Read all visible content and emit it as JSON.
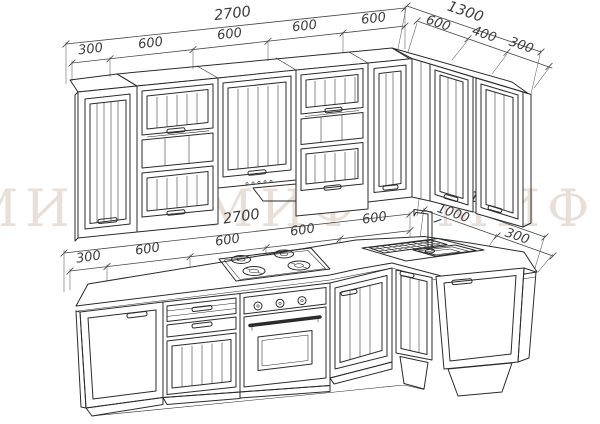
{
  "drawing": {
    "type": "kitchen-corner-set-technical-drawing",
    "background": "#ffffff",
    "line_color": "#2b2b2b",
    "dimension_text_color": "#3d3d3d"
  },
  "watermark": {
    "text": "МИФ  МИФ  МИФ  МИФ",
    "color": "#d3c0b5"
  },
  "dimensions": {
    "upper_left": {
      "overall": "2700",
      "segments": [
        "300",
        "600",
        "600",
        "600",
        "600"
      ]
    },
    "upper_right": {
      "overall": "1300",
      "segments": [
        "600",
        "400",
        "300"
      ]
    },
    "base_left": {
      "overall": "2700",
      "segments": [
        "300",
        "600",
        "600",
        "600",
        "600"
      ]
    },
    "base_right": {
      "overall": "1300",
      "segments": [
        "1000",
        "300"
      ]
    }
  },
  "objects": {
    "wall_cabinets": [
      "angled-end-300",
      "flip-door-with-shelf-600",
      "hood-cabinet-600",
      "flip-door-with-shelf-600",
      "corner-600",
      "door-400",
      "angled-end-300"
    ],
    "base_cabinets": [
      "angled-end-300",
      "drawers-and-door-600",
      "oven-600",
      "door-600",
      "corner-sink-1000",
      "angled-end-300"
    ],
    "fixtures": [
      "gas-cooktop-4-burners",
      "built-in-oven",
      "corner-sink-with-drainer",
      "faucet"
    ]
  }
}
